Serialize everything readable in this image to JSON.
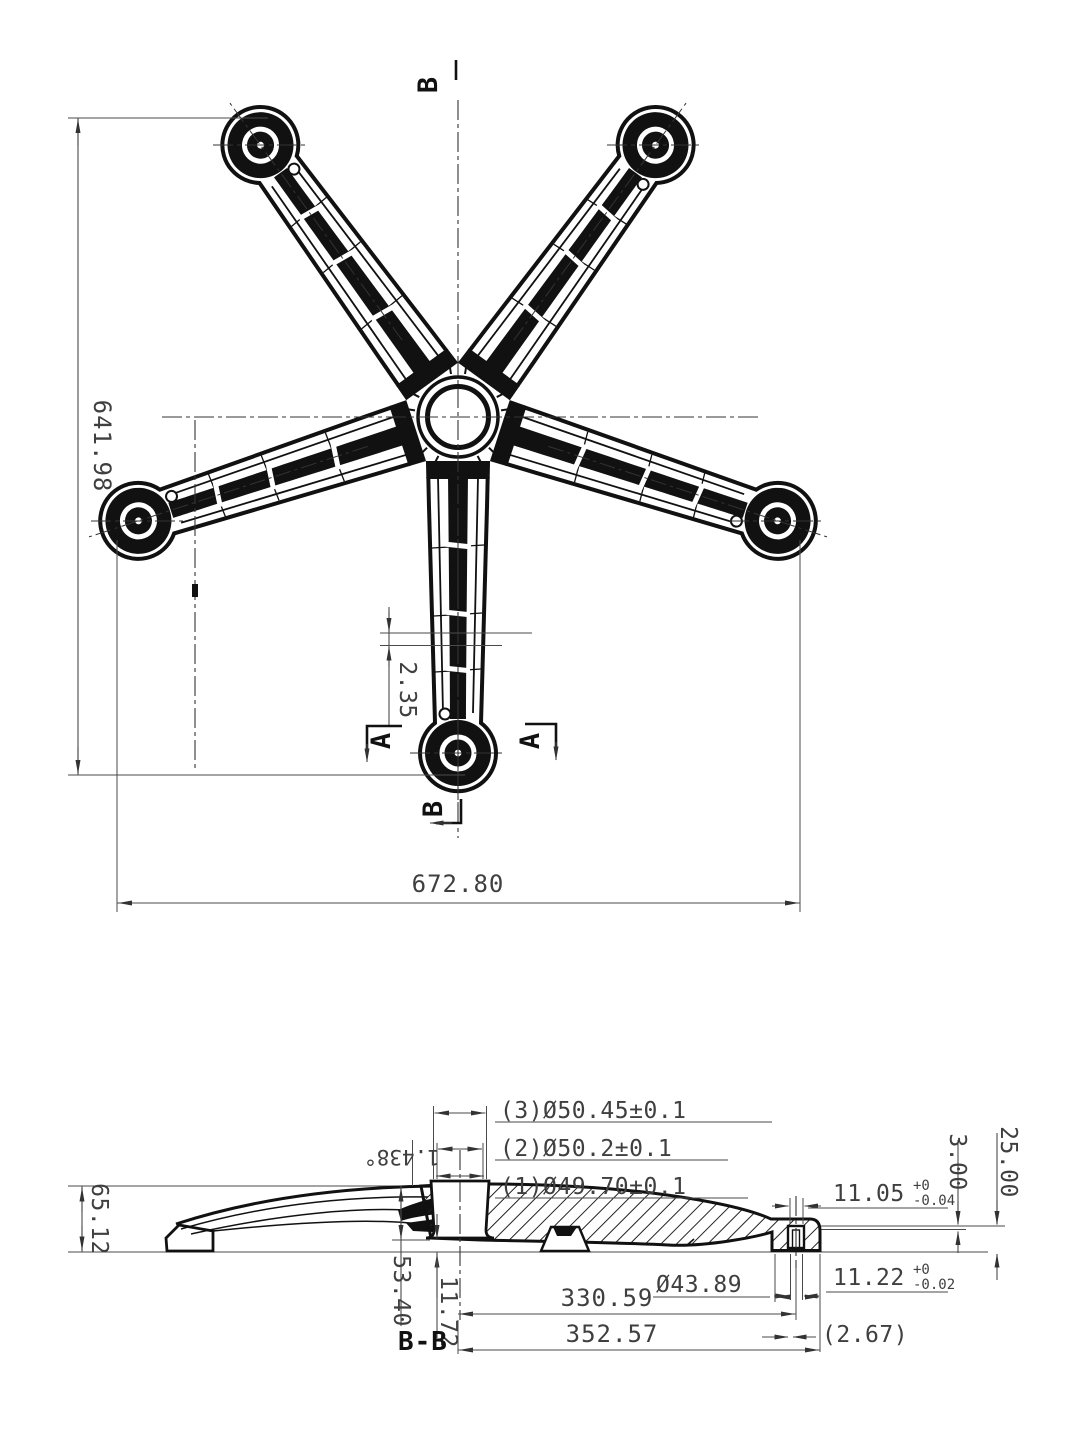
{
  "top_view": {
    "dim_height": "641.98",
    "dim_width": "672.80",
    "dim_rib": "2.35",
    "section_a": "A",
    "section_b": "B"
  },
  "section_view": {
    "label": "B-B",
    "dim_total_height": "65.12",
    "callout_3": "(3)Ø50.45±0.1",
    "callout_2": "(2)Ø50.2±0.1",
    "callout_1": "(1)Ø49.70±0.1",
    "angle": "1.438°",
    "dim_top": "25.00",
    "dim_lip": "3.00",
    "dim_slot_top": "11.05",
    "slot_top_tol_plus": "+0",
    "slot_top_tol_minus": "-0.04",
    "dim_slot_bottom": "11.22",
    "slot_bottom_tol_plus": "+0",
    "slot_bottom_tol_minus": "-0.02",
    "dia_boss": "Ø43.89",
    "dim_hub_to_boss": "330.59",
    "dim_half_span": "352.57",
    "dim_offset": "(2.67)",
    "dim_socket_depth": "53.40",
    "dim_socket_bottom": "11.72"
  }
}
